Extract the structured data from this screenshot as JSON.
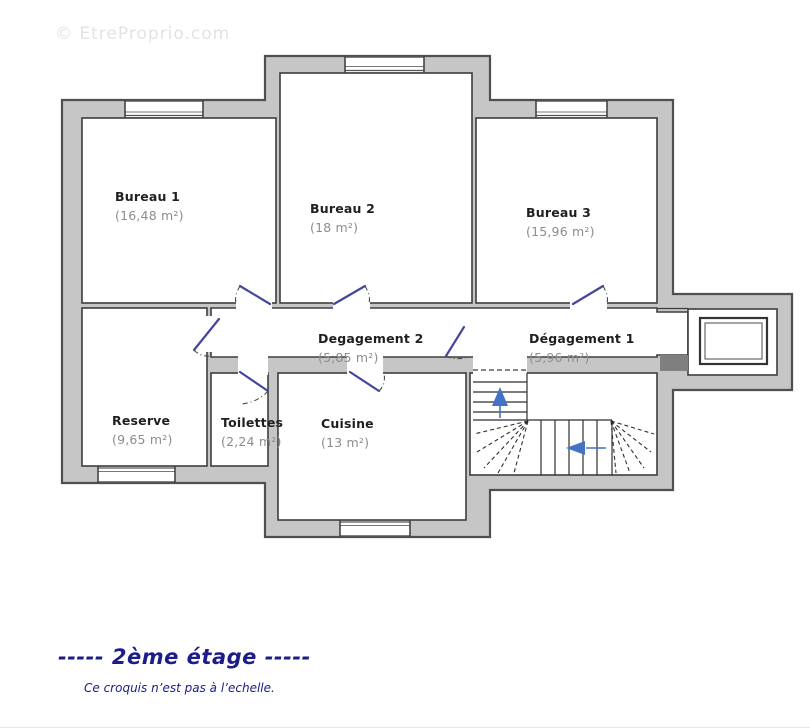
{
  "watermark": "© EtreProprio.com",
  "title": "-----  2ème étage  -----",
  "subtitle": "Ce croquis n’est pas à l’echelle.",
  "rooms": {
    "bureau1": {
      "name": "Bureau 1",
      "area": "(16,48 m²)"
    },
    "bureau2": {
      "name": "Bureau 2",
      "area": "(18 m²)"
    },
    "bureau3": {
      "name": "Bureau 3",
      "area": "(15,96 m²)"
    },
    "degagement2": {
      "name": "Degagement 2",
      "area": "(5,85 m²)"
    },
    "degagement1": {
      "name": "Dégagement 1",
      "area": "(5,96 m²)"
    },
    "reserve": {
      "name": "Reserve",
      "area": "(9,65 m²)"
    },
    "toilettes": {
      "name": "Toilettes",
      "area": "(2,24 m²)"
    },
    "cuisine": {
      "name": "Cuisine",
      "area": "(13 m²)"
    }
  },
  "colors": {
    "wall_fill": "#c6c6c6",
    "wall_outline": "#4f4f4f",
    "door_leaf": "#4646a0",
    "stair_arrow": "#4472c4",
    "title_text": "#1c1c8a",
    "area_text": "#8d8d8d"
  }
}
